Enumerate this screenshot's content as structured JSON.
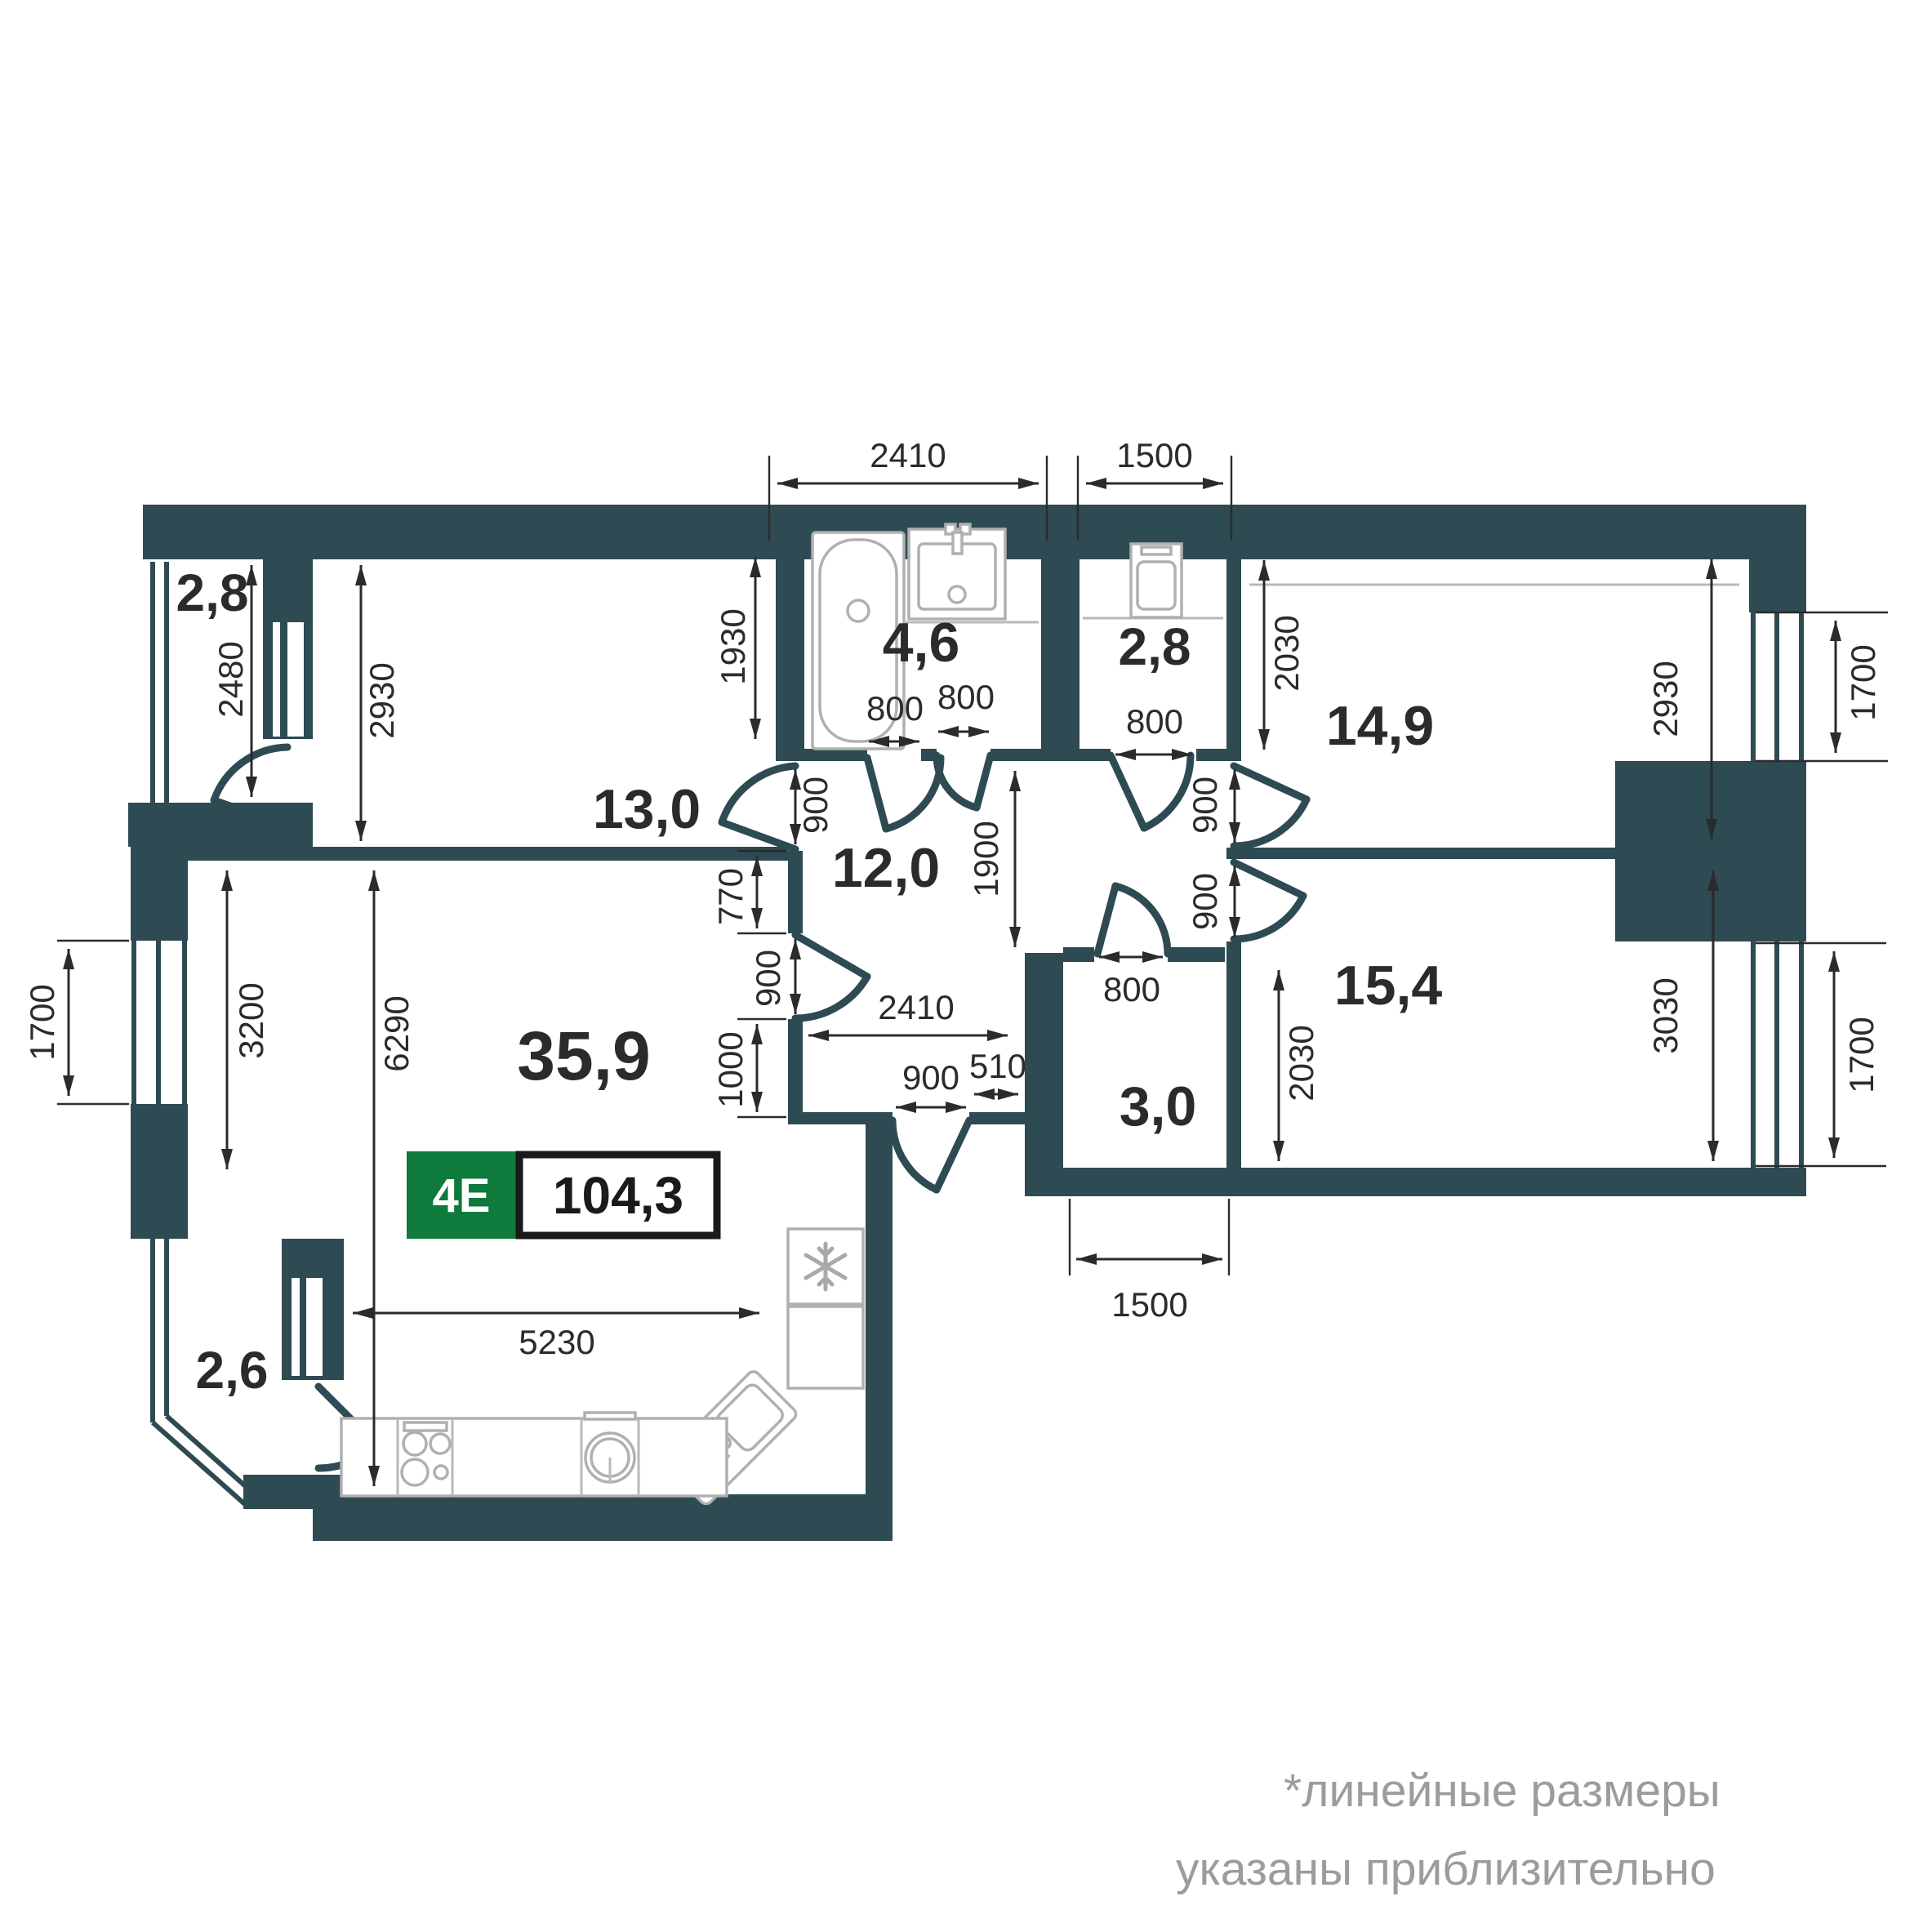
{
  "badge": {
    "type": "4E",
    "area": "104,3"
  },
  "rooms": {
    "hall": "13,0",
    "bathroom": "4,6",
    "laundry": "2,8",
    "bedroom1": "14,9",
    "corridor": "12,0",
    "bedroom2": "15,4",
    "storage": "3,0",
    "living": "35,9",
    "balcony_top": "2,8",
    "balcony_bottom": "2,6"
  },
  "dims": {
    "top_2410": "2410",
    "top_1500": "1500",
    "left_2480": "2480",
    "hall_2930": "2930",
    "bath_1930": "1930",
    "bath_door_800": "800",
    "bath_door2_800": "800",
    "laundry_door_800": "800",
    "hall_door_900": "900",
    "wall_770": "770",
    "living_door_900": "900",
    "wall_1000": "1000",
    "corridor_2410": "2410",
    "corridor_510": "510",
    "entry_door_900": "900",
    "opening_1900": "1900",
    "bedroom1_door_900": "900",
    "bedroom2_door_900": "900",
    "bedroom1_2030": "2030",
    "bedroom2_2030": "2030",
    "bedroom1_2930": "2930",
    "bedroom2_3030": "3030",
    "window_right_top_1700": "1700",
    "window_right_bottom_1700": "1700",
    "window_left_1700": "1700",
    "storage_door_800": "800",
    "storage_1500": "1500",
    "living_3200": "3200",
    "living_6290": "6290",
    "kitchen_5230": "5230"
  },
  "footnote": {
    "line1": "*линейные размеры",
    "line2": "указаны приблизительно"
  },
  "colors": {
    "wall": "#2e4a53",
    "badge_green": "#0e7a3c",
    "dim_text": "#2b2b2b",
    "fixtures": "#b0b0b0",
    "footnote": "#9c9c9c"
  }
}
